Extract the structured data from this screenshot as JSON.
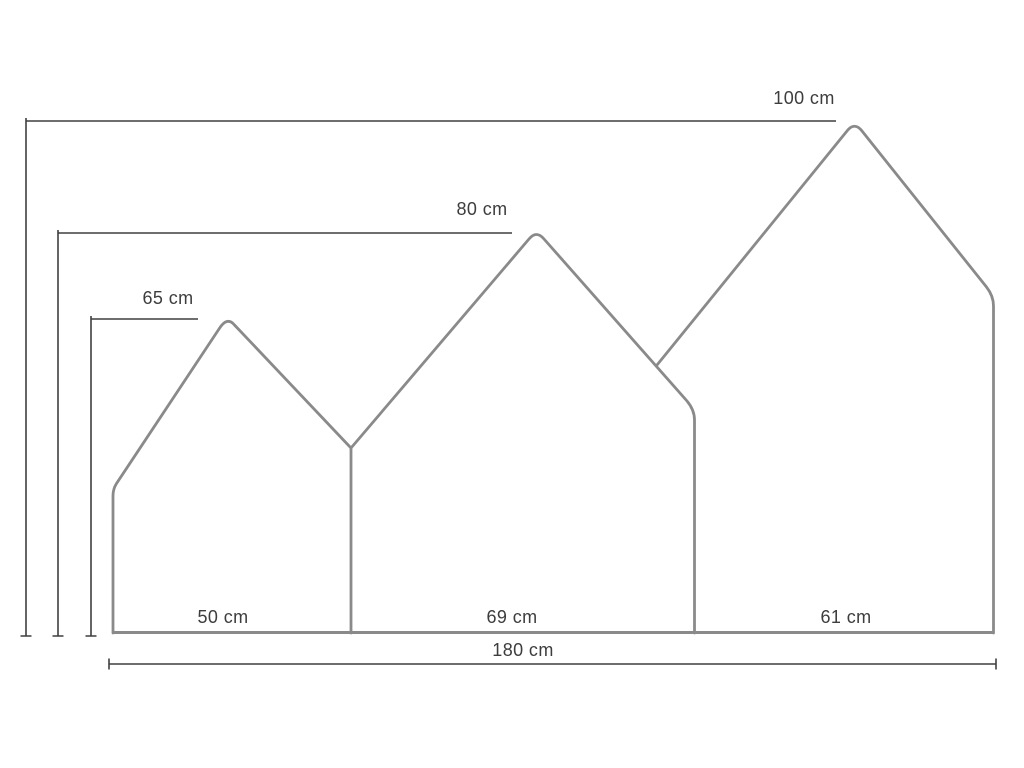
{
  "diagram": {
    "unit": "cm",
    "panels": [
      {
        "position": "left",
        "height": 65,
        "height_label": "65 cm",
        "width": 50,
        "width_label": "50 cm"
      },
      {
        "position": "middle",
        "height": 80,
        "height_label": "80 cm",
        "width": 69,
        "width_label": "69 cm"
      },
      {
        "position": "right",
        "height": 100,
        "height_label": "100 cm",
        "width": 61,
        "width_label": "61 cm"
      }
    ],
    "total_width": {
      "value": 180,
      "label": "180 cm"
    },
    "colors": {
      "background": "#ffffff",
      "panel_outline": "#8a8a8a",
      "dimension_line": "#3f3f3f",
      "label_text": "#3d3d3d"
    }
  }
}
